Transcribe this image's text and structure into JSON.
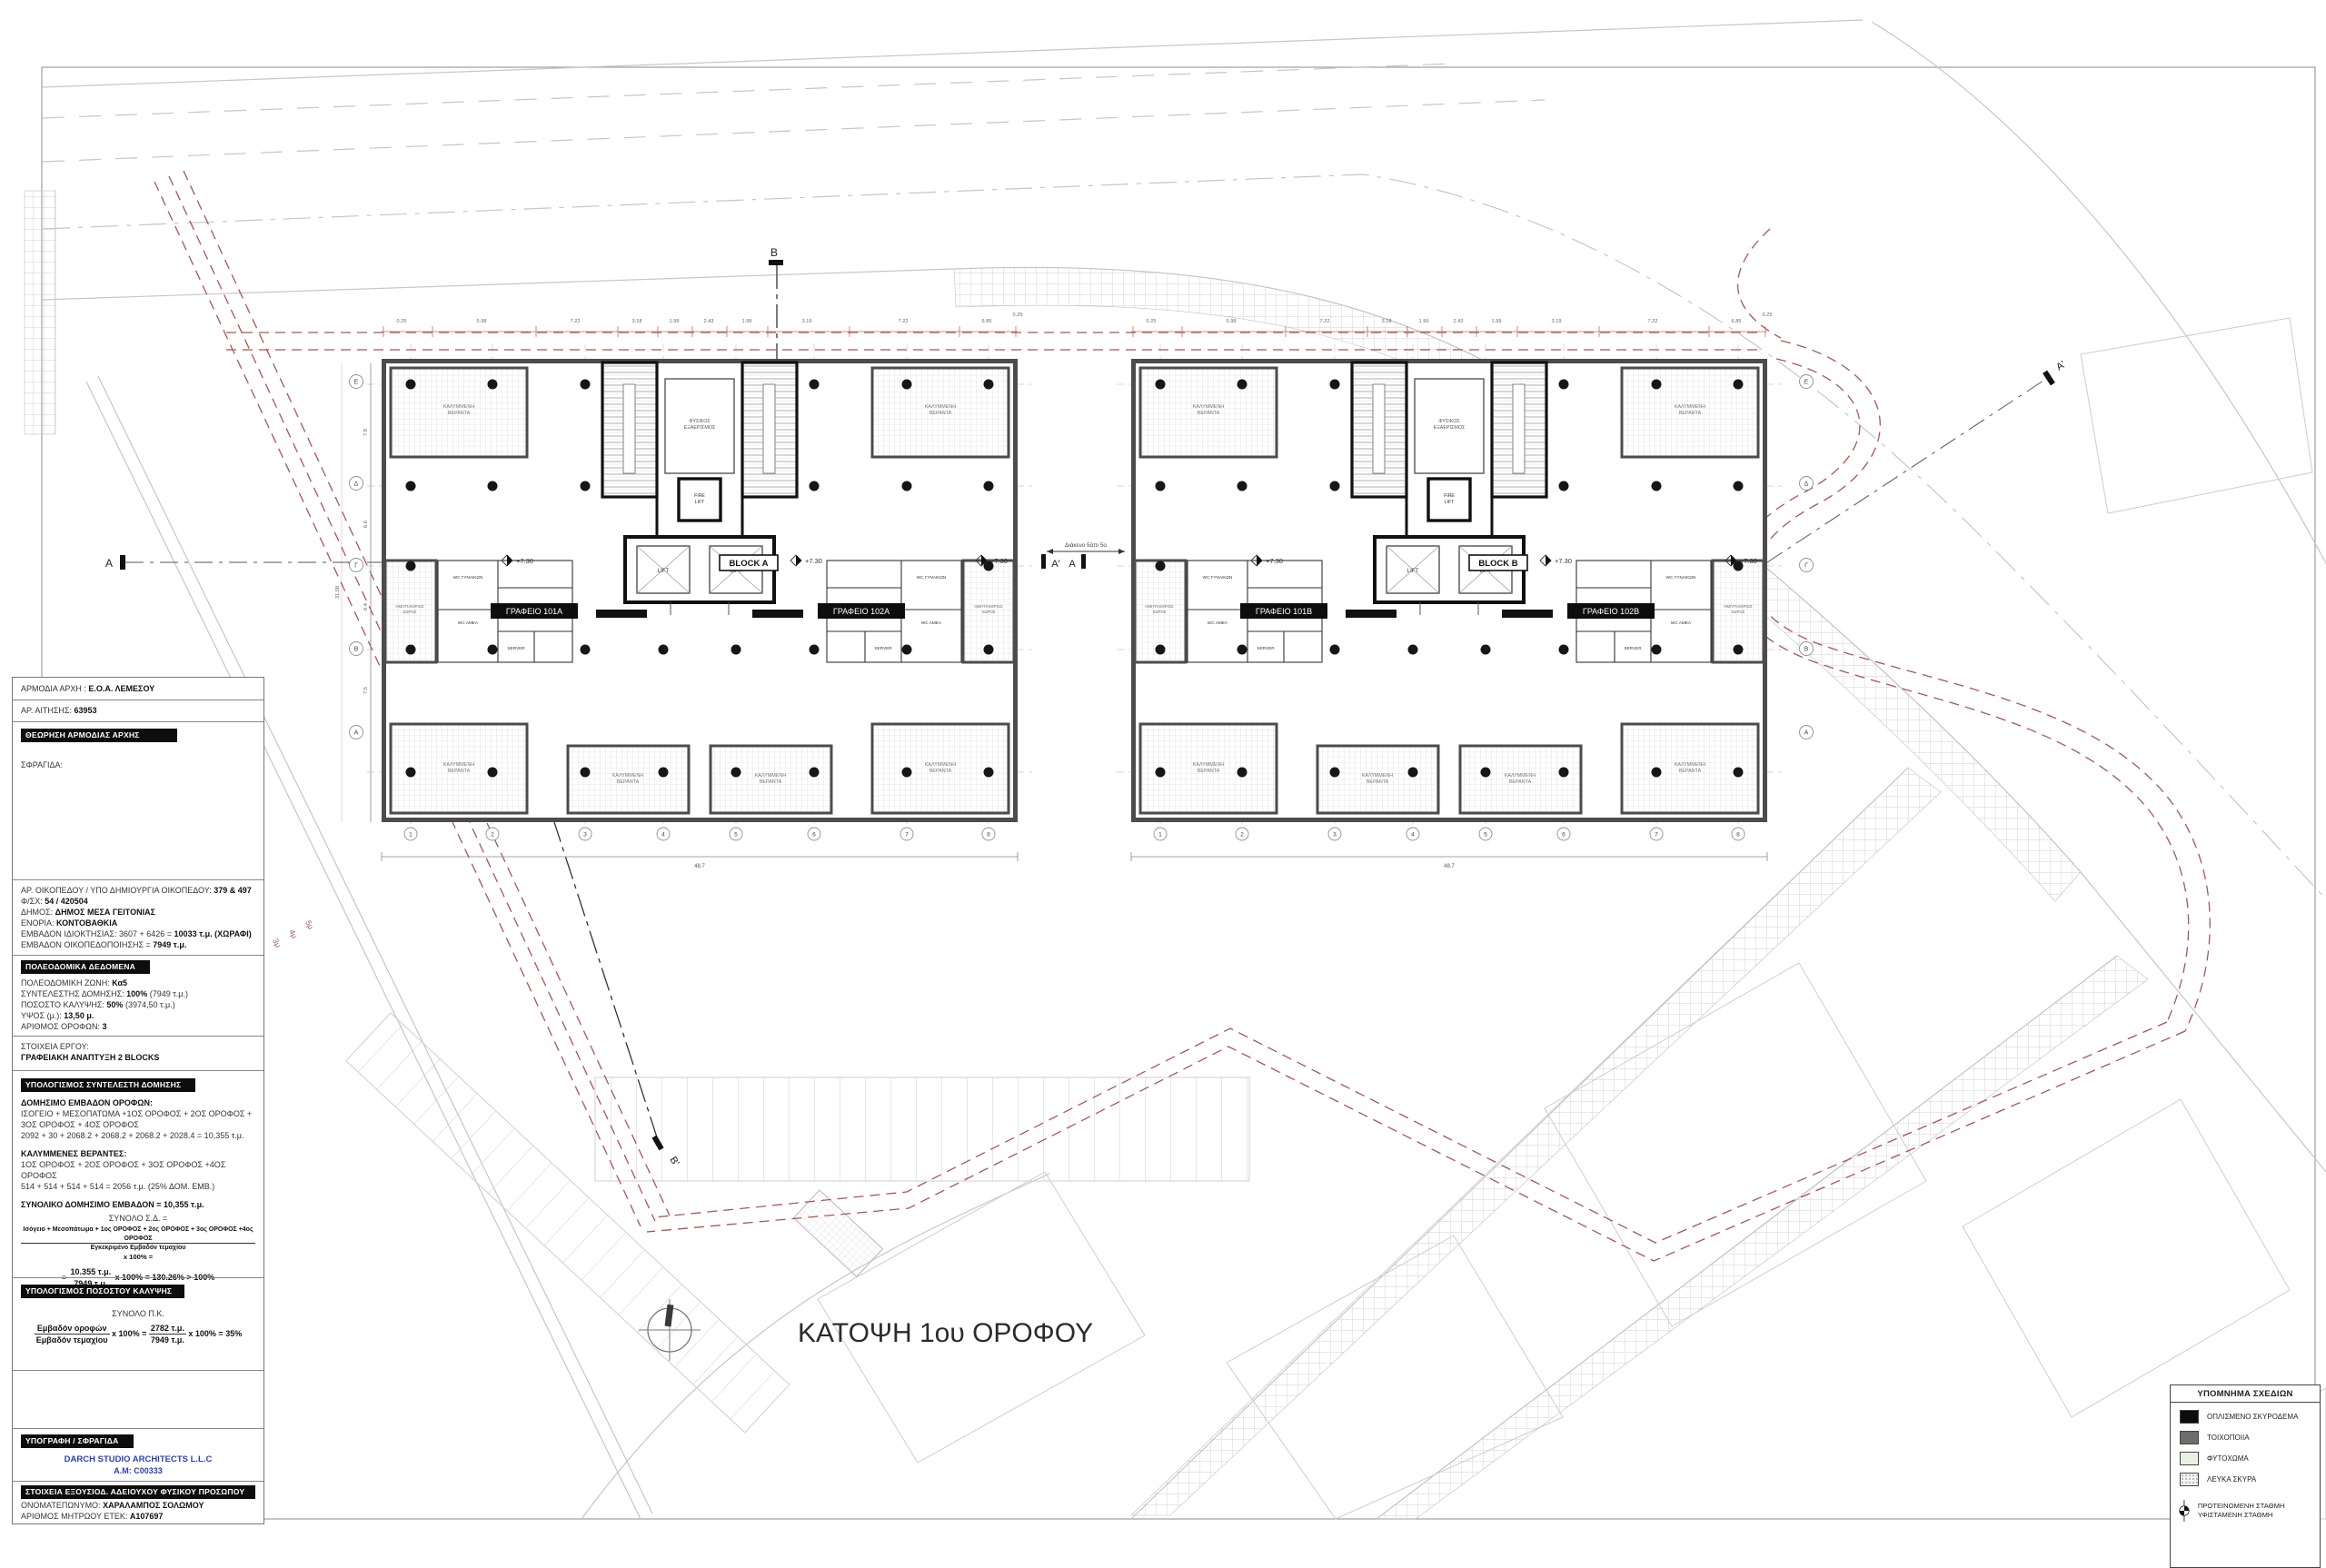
{
  "panel": {
    "authority": {
      "label": "ΑΡΜΟΔΙΑ ΑΡΧΗ :",
      "value": "Ε.Ο.Α. ΛΕΜΕΣΟΥ"
    },
    "application": {
      "label": "ΑΡ. ΑΙΤΗΣΗΣ:",
      "value": "63953"
    },
    "review_header": "ΘΕΩΡΗΣΗ ΑΡΜΟΔΙΑΣ ΑΡΧΗΣ",
    "stamp_label": "ΣΦΡΑΓΙΔΑ:",
    "site_lines": [
      {
        "label": "ΑΡ. ΟΙΚΟΠΕΔΟΥ / ΥΠΟ ΔΗΜΙΟΥΡΓΙΑ ΟΙΚΟΠΕΔΟΥ:",
        "value": "379 & 497"
      },
      {
        "label": "Φ/ΣΧ:",
        "value": "54 / 420504"
      },
      {
        "label": "ΔΗΜΟΣ:",
        "value": "ΔΗΜΟΣ ΜΕΣΑ ΓΕΙΤΟΝΙΑΣ"
      },
      {
        "label": "ΕΝΟΡΙΑ:",
        "value": "ΚΟΝΤΟΒΑΘΚΙΑ"
      },
      {
        "label": "ΕΜΒΑΔΟΝ ΙΔΙΟΚΤΗΣΙΑΣ: 3607 + 6426 =",
        "value": "10033 τ.μ. (ΧΩΡΑΦΙ)"
      },
      {
        "label": "ΕΜΒΑΔΟΝ ΟΙΚΟΠΕΔΟΠΟΙΗΣΗΣ =",
        "value": "7949 τ.μ."
      }
    ],
    "zoning_header": "ΠΟΛΕΟΔΟΜΙΚΑ ΔΕΔΟΜΕΝΑ",
    "zoning_lines": [
      {
        "label": "ΠΟΛΕΟΔΟΜΙΚΗ ΖΩΝΗ:",
        "value": "Κα5",
        "suffix": ""
      },
      {
        "label": "ΣΥΝΤΕΛΕΣΤΗΣ ΔΟΜΗΣΗΣ:",
        "value": "100%",
        "suffix": "(7949 τ.μ.)"
      },
      {
        "label": "ΠΟΣΟΣΤΟ ΚΑΛΥΨΗΣ:",
        "value": "50%",
        "suffix": "(3974,50 τ.μ.)"
      },
      {
        "label": "ΥΨΟΣ (μ.):",
        "value": "13,50 μ.",
        "suffix": ""
      },
      {
        "label": "ΑΡΙΘΜΟΣ ΟΡΟΦΩΝ:",
        "value": "3",
        "suffix": ""
      }
    ],
    "project_label": "ΣΤΟΙΧΕΙΑ ΕΡΓΟΥ:",
    "project_value": "ΓΡΑΦΕΙΑΚΗ ΑΝΑΠΤΥΞΗ 2 BLOCKS",
    "far_header": "ΥΠΟΛΟΓΙΣΜΟΣ ΣΥΝΤΕΛΕΣΤΗ ΔΟΜΗΣΗΣ",
    "far": {
      "floors_title": "ΔΟΜΗΣΙΜΟ ΕΜΒΑΔΟΝ ΟΡΟΦΩΝ:",
      "floors_line1": "ΙΣΟΓΕΙΟ + ΜΕΣΟΠΑΤΩΜΑ +1ΟΣ ΟΡΟΦΟΣ + 2ΟΣ ΟΡΟΦΟΣ +",
      "floors_line2": "3ΟΣ ΟΡΟΦΟΣ + 4ΟΣ ΟΡΟΦΟΣ",
      "floors_sum": "2092 + 30 + 2068.2 + 2068.2 + 2068.2 + 2028.4 = 10,355 τ.μ.",
      "verandas_title": "ΚΑΛΥΜΜΕΝΕΣ ΒΕΡΑΝΤΕΣ:",
      "verandas_line1": "1ΟΣ ΟΡΟΦΟΣ + 2ΟΣ ΟΡΟΦΟΣ + 3ΟΣ ΟΡΟΦΟΣ +4ΟΣ ΟΡΟΦΟΣ",
      "verandas_sum": "514 + 514 + 514 + 514 =  2056 τ.μ. (25% ΔΟΜ. ΕΜΒ.)",
      "total": "ΣΥΝΟΛΙΚΟ ΔΟΜΗΣΙΜΟ ΕΜΒΑΔΟΝ = 10,355 τ.μ.",
      "ratio_label": "ΣΥΝΟΛΟ Σ.Δ. =",
      "ratio_num": "Ισόγειο + Μεσοπάτωμα + 1ος ΟΡΟΦΟΣ + 2ος ΟΡΟΦΟΣ + 3ος ΟΡΟΦΟΣ +4ος ΟΡΟΦΟΣ",
      "ratio_den": "Εγκεκριμένο Εμβαδόν τεμαχίου",
      "ratio_x": "x 100% =",
      "result_eq": "=",
      "result_num": "10.355 τ.μ.",
      "result_den": "7949 τ.μ.",
      "result_rest": "x 100% = 130.26% > 100%"
    },
    "coverage_header": "ΥΠΟΛΟΓΙΣΜΟΣ ΠΟΣΟΣΤΟΥ ΚΑΛΥΨΗΣ",
    "coverage": {
      "total_label": "ΣΥΝΟΛΟ Π.Κ.",
      "num": "Εμβαδόν οροφών",
      "den": "Εμβαδόν τεμαχίου",
      "x": "x 100% =",
      "num2": "2782 τ.μ.",
      "den2": "7949 τ.μ.",
      "rest": "x 100% = 35%"
    },
    "signature_header": "ΥΠΟΓΡΑΦΗ / ΣΦΡΑΓΙΔΑ",
    "firm_name": "DARCH STUDIO ARCHITECTS L.L.C",
    "firm_reg": "A.M:  C00333",
    "licensee_header": "ΣΤΟΙΧΕΙΑ ΕΞΟΥΣΙΟΔ. ΑΔΕΙΟΥΧΟΥ ΦΥΣΙΚΟΥ ΠΡΟΣΩΠΟΥ",
    "licensee_name": {
      "label": "ΟΝΟΜΑΤΕΠΩΝΥΜΟ:",
      "value": "ΧΑΡΑΛΑΜΠΟΣ ΣΟΛΩΜΟΥ"
    },
    "licensee_reg": {
      "label": "ΑΡΙΘΜΟΣ ΜΗΤΡΩΟΥ ΕΤΕΚ:",
      "value": "A107697"
    }
  },
  "plan": {
    "title": "ΚΑΤΟΨΗ 1ου ΟΡΟΦΟΥ",
    "blocks": [
      {
        "name": "BLOCK A",
        "office_left": "ΓΡΑΦΕΙΟ 101Α",
        "office_right": "ΓΡΑΦΕΙΟ 102Α"
      },
      {
        "name": "BLOCK B",
        "office_left": "ΓΡΑΦΕΙΟ 101Β",
        "office_right": "ΓΡΑΦΕΙΟ 102Β"
      }
    ],
    "rooms": {
      "veranda1": "ΚΑΛΥΜΜΕΝΗ",
      "veranda2": "ΒΕΡΑΝΤΑ",
      "vent1": "ΦΥΣΙΚΟΣ",
      "vent2": "ΕΞΑΕΡΙΣΜΟΣ",
      "fire1": "FIRE",
      "fire2": "LIFT",
      "lift": "LIFT",
      "wc_women": "WC ΓΥΝΑΙΚΩΝ",
      "wc_men": "WC ΑΝΔΡΩΝ",
      "wc_amea": "WC AMEA",
      "server": "SERVER",
      "semi1": "ΗΜΙΥΠΑΙΘΡΙΟΣ",
      "semi2": "ΧΩΡΟΣ"
    },
    "level_mark": "+7.30",
    "gap_note": "Διάκενο 5άπι 5ο",
    "sections": {
      "a": "A",
      "a_prime": "A'",
      "b": "B",
      "b_prime": "B'"
    },
    "setbacks": [
      "3μ",
      "4μ",
      "5μ"
    ],
    "grid_letters": [
      "Ε",
      "Δ",
      "Γ",
      "Β",
      "Α"
    ],
    "grid_numbers": [
      "1",
      "2",
      "3",
      "4",
      "5",
      "6",
      "7",
      "8"
    ],
    "dims_top": [
      "0.25",
      "5.98",
      "7.22",
      "3.18",
      "1.99",
      "2.43",
      "1.99",
      "3.19",
      "7.22",
      "6.85",
      "0.25"
    ],
    "dims_left": [
      "7.8",
      "6.6",
      "6.4",
      "7.5"
    ],
    "dim_total_width": "48.7",
    "dim_total_height": "31.08"
  },
  "legend": {
    "title": "ΥΠΟΜΝΗΜΑ ΣΧΕΔΙΩΝ",
    "items": [
      {
        "label": "ΟΠΛΙΣΜΕΝΟ ΣΚΥΡΟΔΕΜΑ",
        "color": "#0d0d0d"
      },
      {
        "label": "ΤΟΙΧΟΠΟΙΙΑ",
        "color": "#6d6d6d"
      },
      {
        "label": "ΦΥΤΟΧΩΜΑ",
        "color": "#e9f2e2"
      },
      {
        "label": "ΛΕΥΚΑ ΣΚΥΡΑ",
        "color": "stipple"
      }
    ],
    "level_proposed": "ΠΡΟΤΕΙΝΟΜΕΝΗ ΣΤΑΘΜΗ",
    "level_existing": "ΥΦΙΣΤΑΜΕΝΗ ΣΤΑΘΜΗ"
  },
  "colors": {
    "boundary": "#a85752",
    "wall": "#4c4c4c",
    "dims": "#c06a62",
    "roads": "#c6c6c6",
    "accent_blue": "#2d3fc0"
  }
}
